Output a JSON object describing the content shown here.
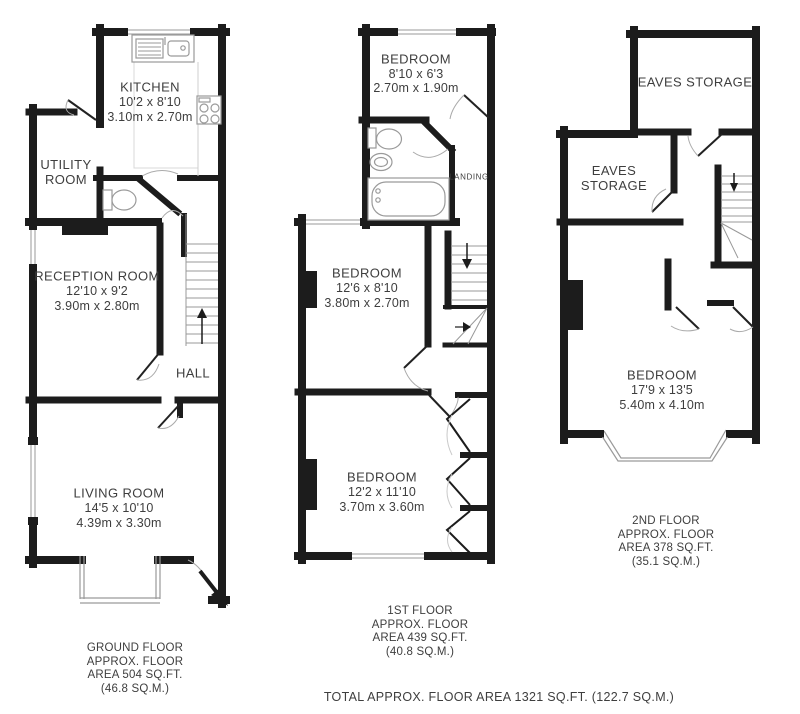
{
  "floors": {
    "ground": {
      "rooms": {
        "kitchen": {
          "name": "KITCHEN",
          "imperial": "10'2 x 8'10",
          "metric": "3.10m x 2.70m"
        },
        "utility": {
          "name": "UTILITY ROOM"
        },
        "reception": {
          "name": "RECEPTION ROOM",
          "imperial": "12'10 x 9'2",
          "metric": "3.90m x 2.80m"
        },
        "hall": {
          "name": "HALL"
        },
        "living": {
          "name": "LIVING ROOM",
          "imperial": "14'5 x 10'10",
          "metric": "4.39m x 3.30m"
        }
      },
      "area_label": "GROUND FLOOR\nAPPROX. FLOOR\nAREA 504 SQ.FT.\n(46.8 SQ.M.)"
    },
    "first": {
      "rooms": {
        "bedroom_front": {
          "name": "BEDROOM",
          "imperial": "8'10 x 6'3",
          "metric": "2.70m x 1.90m"
        },
        "landing": {
          "name": "LANDING"
        },
        "bedroom_mid": {
          "name": "BEDROOM",
          "imperial": "12'6 x 8'10",
          "metric": "3.80m x 2.70m"
        },
        "bedroom_rear": {
          "name": "BEDROOM",
          "imperial": "12'2 x 11'10",
          "metric": "3.70m x 3.60m"
        }
      },
      "area_label": "1ST FLOOR\nAPPROX. FLOOR\nAREA 439 SQ.FT.\n(40.8 SQ.M.)"
    },
    "second": {
      "rooms": {
        "eaves_top": {
          "name": "EAVES STORAGE"
        },
        "eaves_left": {
          "name": "EAVES STORAGE"
        },
        "bedroom_main": {
          "name": "BEDROOM",
          "imperial": "17'9 x 13'5",
          "metric": "5.40m x 4.10m"
        }
      },
      "area_label": "2ND FLOOR\nAPPROX. FLOOR\nAREA 378 SQ.FT.\n(35.1 SQ.M.)"
    }
  },
  "footer": {
    "total_area": "TOTAL APPROX. FLOOR AREA 1321 SQ.FT. (122.7 SQ.M.)"
  },
  "colors": {
    "wall": "#1c1c1c",
    "fixture": "#9a9a9a",
    "text": "#3e3e3e"
  }
}
